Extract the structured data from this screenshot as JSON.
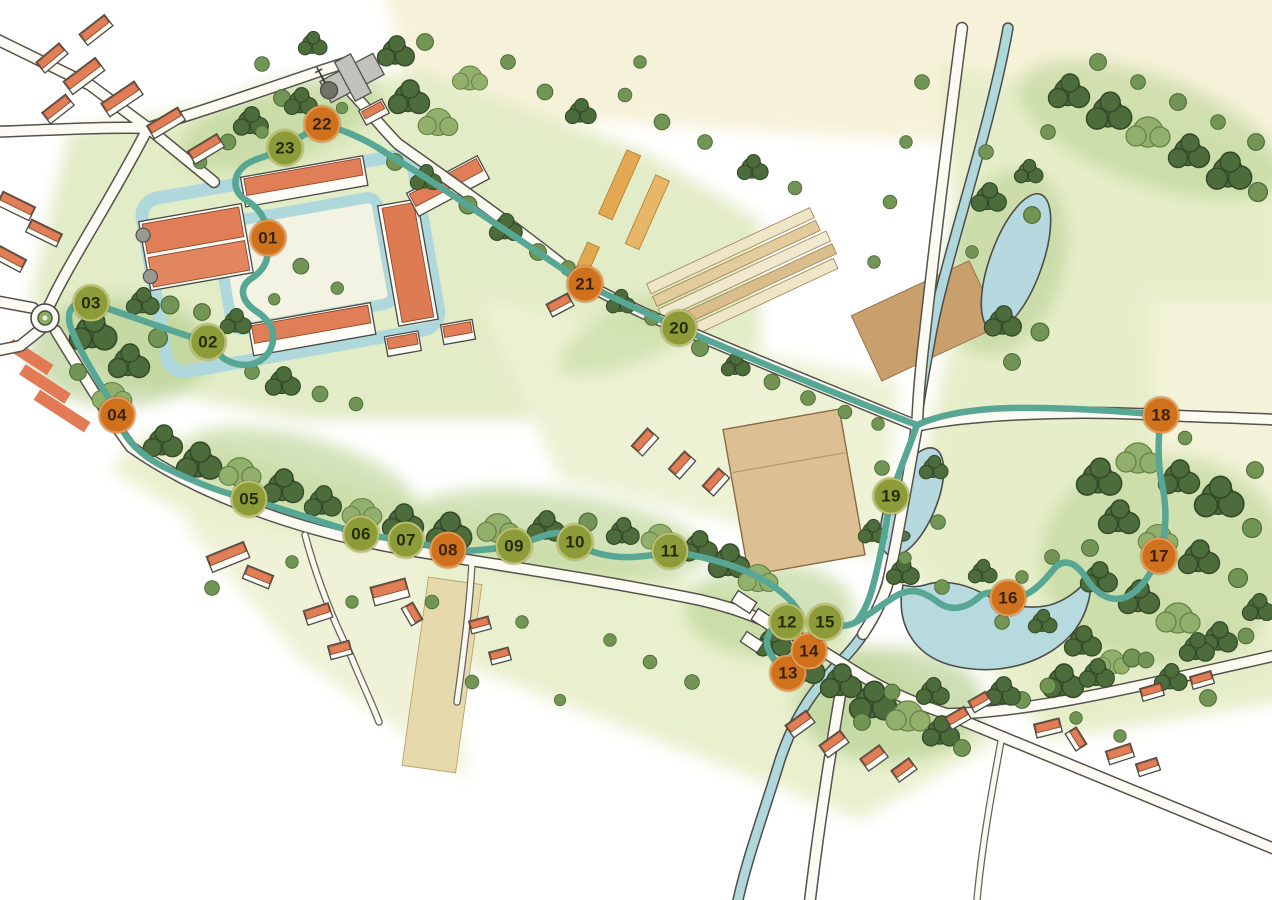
{
  "map": {
    "kind": "illustrated-walking-trail-map",
    "stops": [
      {
        "label": "01",
        "variant": "orange",
        "x": 268,
        "y": 238
      },
      {
        "label": "02",
        "variant": "olive",
        "x": 208,
        "y": 342
      },
      {
        "label": "03",
        "variant": "olive",
        "x": 91,
        "y": 303
      },
      {
        "label": "04",
        "variant": "orange",
        "x": 117,
        "y": 415
      },
      {
        "label": "05",
        "variant": "olive",
        "x": 249,
        "y": 499
      },
      {
        "label": "06",
        "variant": "olive",
        "x": 361,
        "y": 534
      },
      {
        "label": "07",
        "variant": "olive",
        "x": 406,
        "y": 540
      },
      {
        "label": "08",
        "variant": "orange",
        "x": 448,
        "y": 550
      },
      {
        "label": "09",
        "variant": "olive",
        "x": 514,
        "y": 546
      },
      {
        "label": "10",
        "variant": "olive",
        "x": 575,
        "y": 542
      },
      {
        "label": "11",
        "variant": "olive",
        "x": 670,
        "y": 551
      },
      {
        "label": "12",
        "variant": "olive",
        "x": 787,
        "y": 622
      },
      {
        "label": "13",
        "variant": "orange",
        "x": 788,
        "y": 673
      },
      {
        "label": "14",
        "variant": "orange",
        "x": 809,
        "y": 651
      },
      {
        "label": "15",
        "variant": "olive",
        "x": 825,
        "y": 622
      },
      {
        "label": "16",
        "variant": "orange",
        "x": 1008,
        "y": 598
      },
      {
        "label": "17",
        "variant": "orange",
        "x": 1159,
        "y": 556
      },
      {
        "label": "18",
        "variant": "orange",
        "x": 1161,
        "y": 415
      },
      {
        "label": "19",
        "variant": "olive",
        "x": 891,
        "y": 496
      },
      {
        "label": "20",
        "variant": "olive",
        "x": 679,
        "y": 328
      },
      {
        "label": "21",
        "variant": "orange",
        "x": 585,
        "y": 284
      },
      {
        "label": "22",
        "variant": "orange",
        "x": 322,
        "y": 124
      },
      {
        "label": "23",
        "variant": "olive",
        "x": 285,
        "y": 148
      }
    ],
    "colors": {
      "trail": "#58a795",
      "water": "#afd8dc",
      "roof": "#df7e57",
      "m_orange": "#d0711e",
      "m_orange_rim": "#e49a55",
      "m_orange_text": "#3a2408",
      "m_olive": "#8d9b38",
      "m_olive_rim": "#bcc172",
      "m_olive_text": "#262d08"
    }
  }
}
